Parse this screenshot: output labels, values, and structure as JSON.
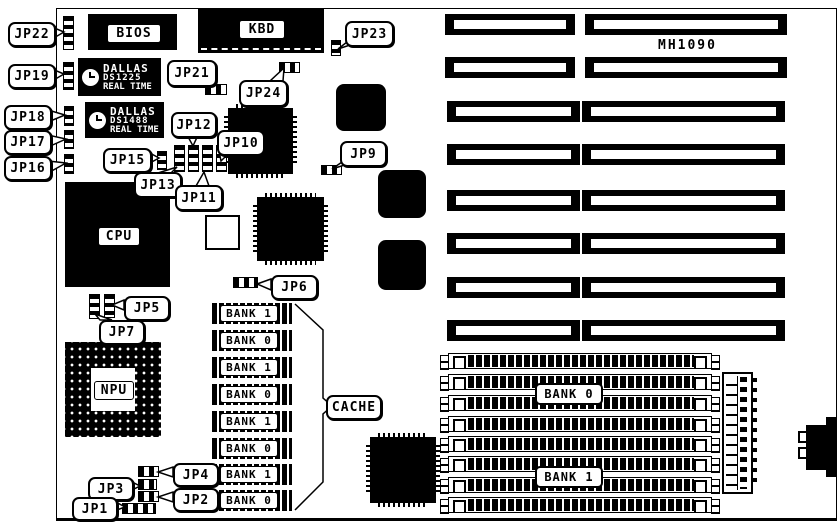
{
  "board": {
    "model": "MH1090",
    "colors": {
      "ink": "#000000",
      "paper": "#ffffff"
    }
  },
  "chips": {
    "bios": {
      "label": "BIOS"
    },
    "kbd": {
      "label": "KBD"
    },
    "cpu": {
      "label": "CPU"
    },
    "npu": {
      "label": "NPU"
    },
    "dallas_rtc_1": {
      "brand": "DALLAS",
      "part": "DS1225",
      "caption": "REAL TIME",
      "icon": "alarm-clock-icon"
    },
    "dallas_rtc_2": {
      "brand": "DALLAS",
      "part": "DS1488",
      "caption": "REAL TIME",
      "icon": "alarm-clock-icon"
    }
  },
  "jumpers": [
    {
      "id": "jp22",
      "label": "JP22"
    },
    {
      "id": "jp19",
      "label": "JP19"
    },
    {
      "id": "jp18",
      "label": "JP18"
    },
    {
      "id": "jp17",
      "label": "JP17"
    },
    {
      "id": "jp16",
      "label": "JP16"
    },
    {
      "id": "jp23",
      "label": "JP23"
    },
    {
      "id": "jp21",
      "label": "JP21"
    },
    {
      "id": "jp24",
      "label": "JP24"
    },
    {
      "id": "jp12",
      "label": "JP12"
    },
    {
      "id": "jp10",
      "label": "JP10"
    },
    {
      "id": "jp15",
      "label": "JP15"
    },
    {
      "id": "jp13",
      "label": "JP13"
    },
    {
      "id": "jp11",
      "label": "JP11"
    },
    {
      "id": "jp9",
      "label": "JP9"
    },
    {
      "id": "jp6",
      "label": "JP6"
    },
    {
      "id": "jp5",
      "label": "JP5"
    },
    {
      "id": "jp7",
      "label": "JP7"
    },
    {
      "id": "jp4",
      "label": "JP4"
    },
    {
      "id": "jp3",
      "label": "JP3"
    },
    {
      "id": "jp2",
      "label": "JP2"
    },
    {
      "id": "jp1",
      "label": "JP1"
    }
  ],
  "cache": {
    "label": "CACHE",
    "chips": [
      "BANK 1",
      "BANK 0",
      "BANK 1",
      "BANK 0",
      "BANK 1",
      "BANK 0",
      "BANK 1",
      "BANK 0"
    ]
  },
  "memory": {
    "labels": [
      "BANK 0",
      "BANK 1"
    ],
    "socket_count": 8
  },
  "expansion_slots": {
    "count": 8
  }
}
